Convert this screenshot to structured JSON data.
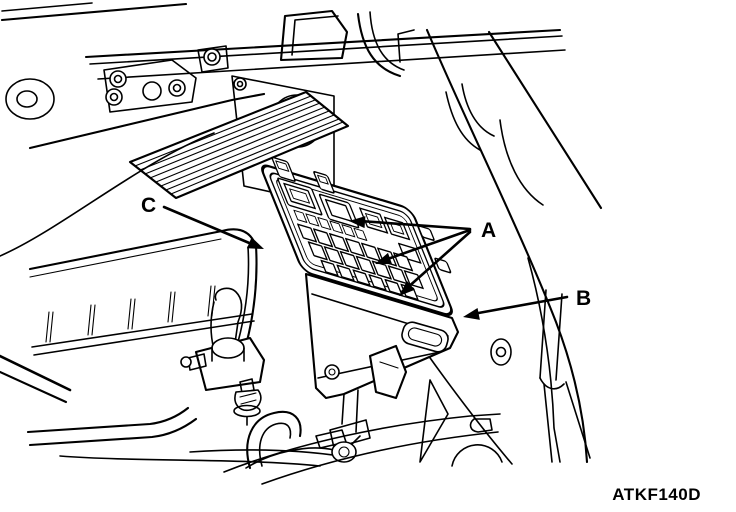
{
  "figure": {
    "code": "ATKF140D",
    "background": "#ffffff",
    "line_color": "#000000"
  },
  "callouts": {
    "a": "A",
    "b": "B",
    "c": "C"
  }
}
